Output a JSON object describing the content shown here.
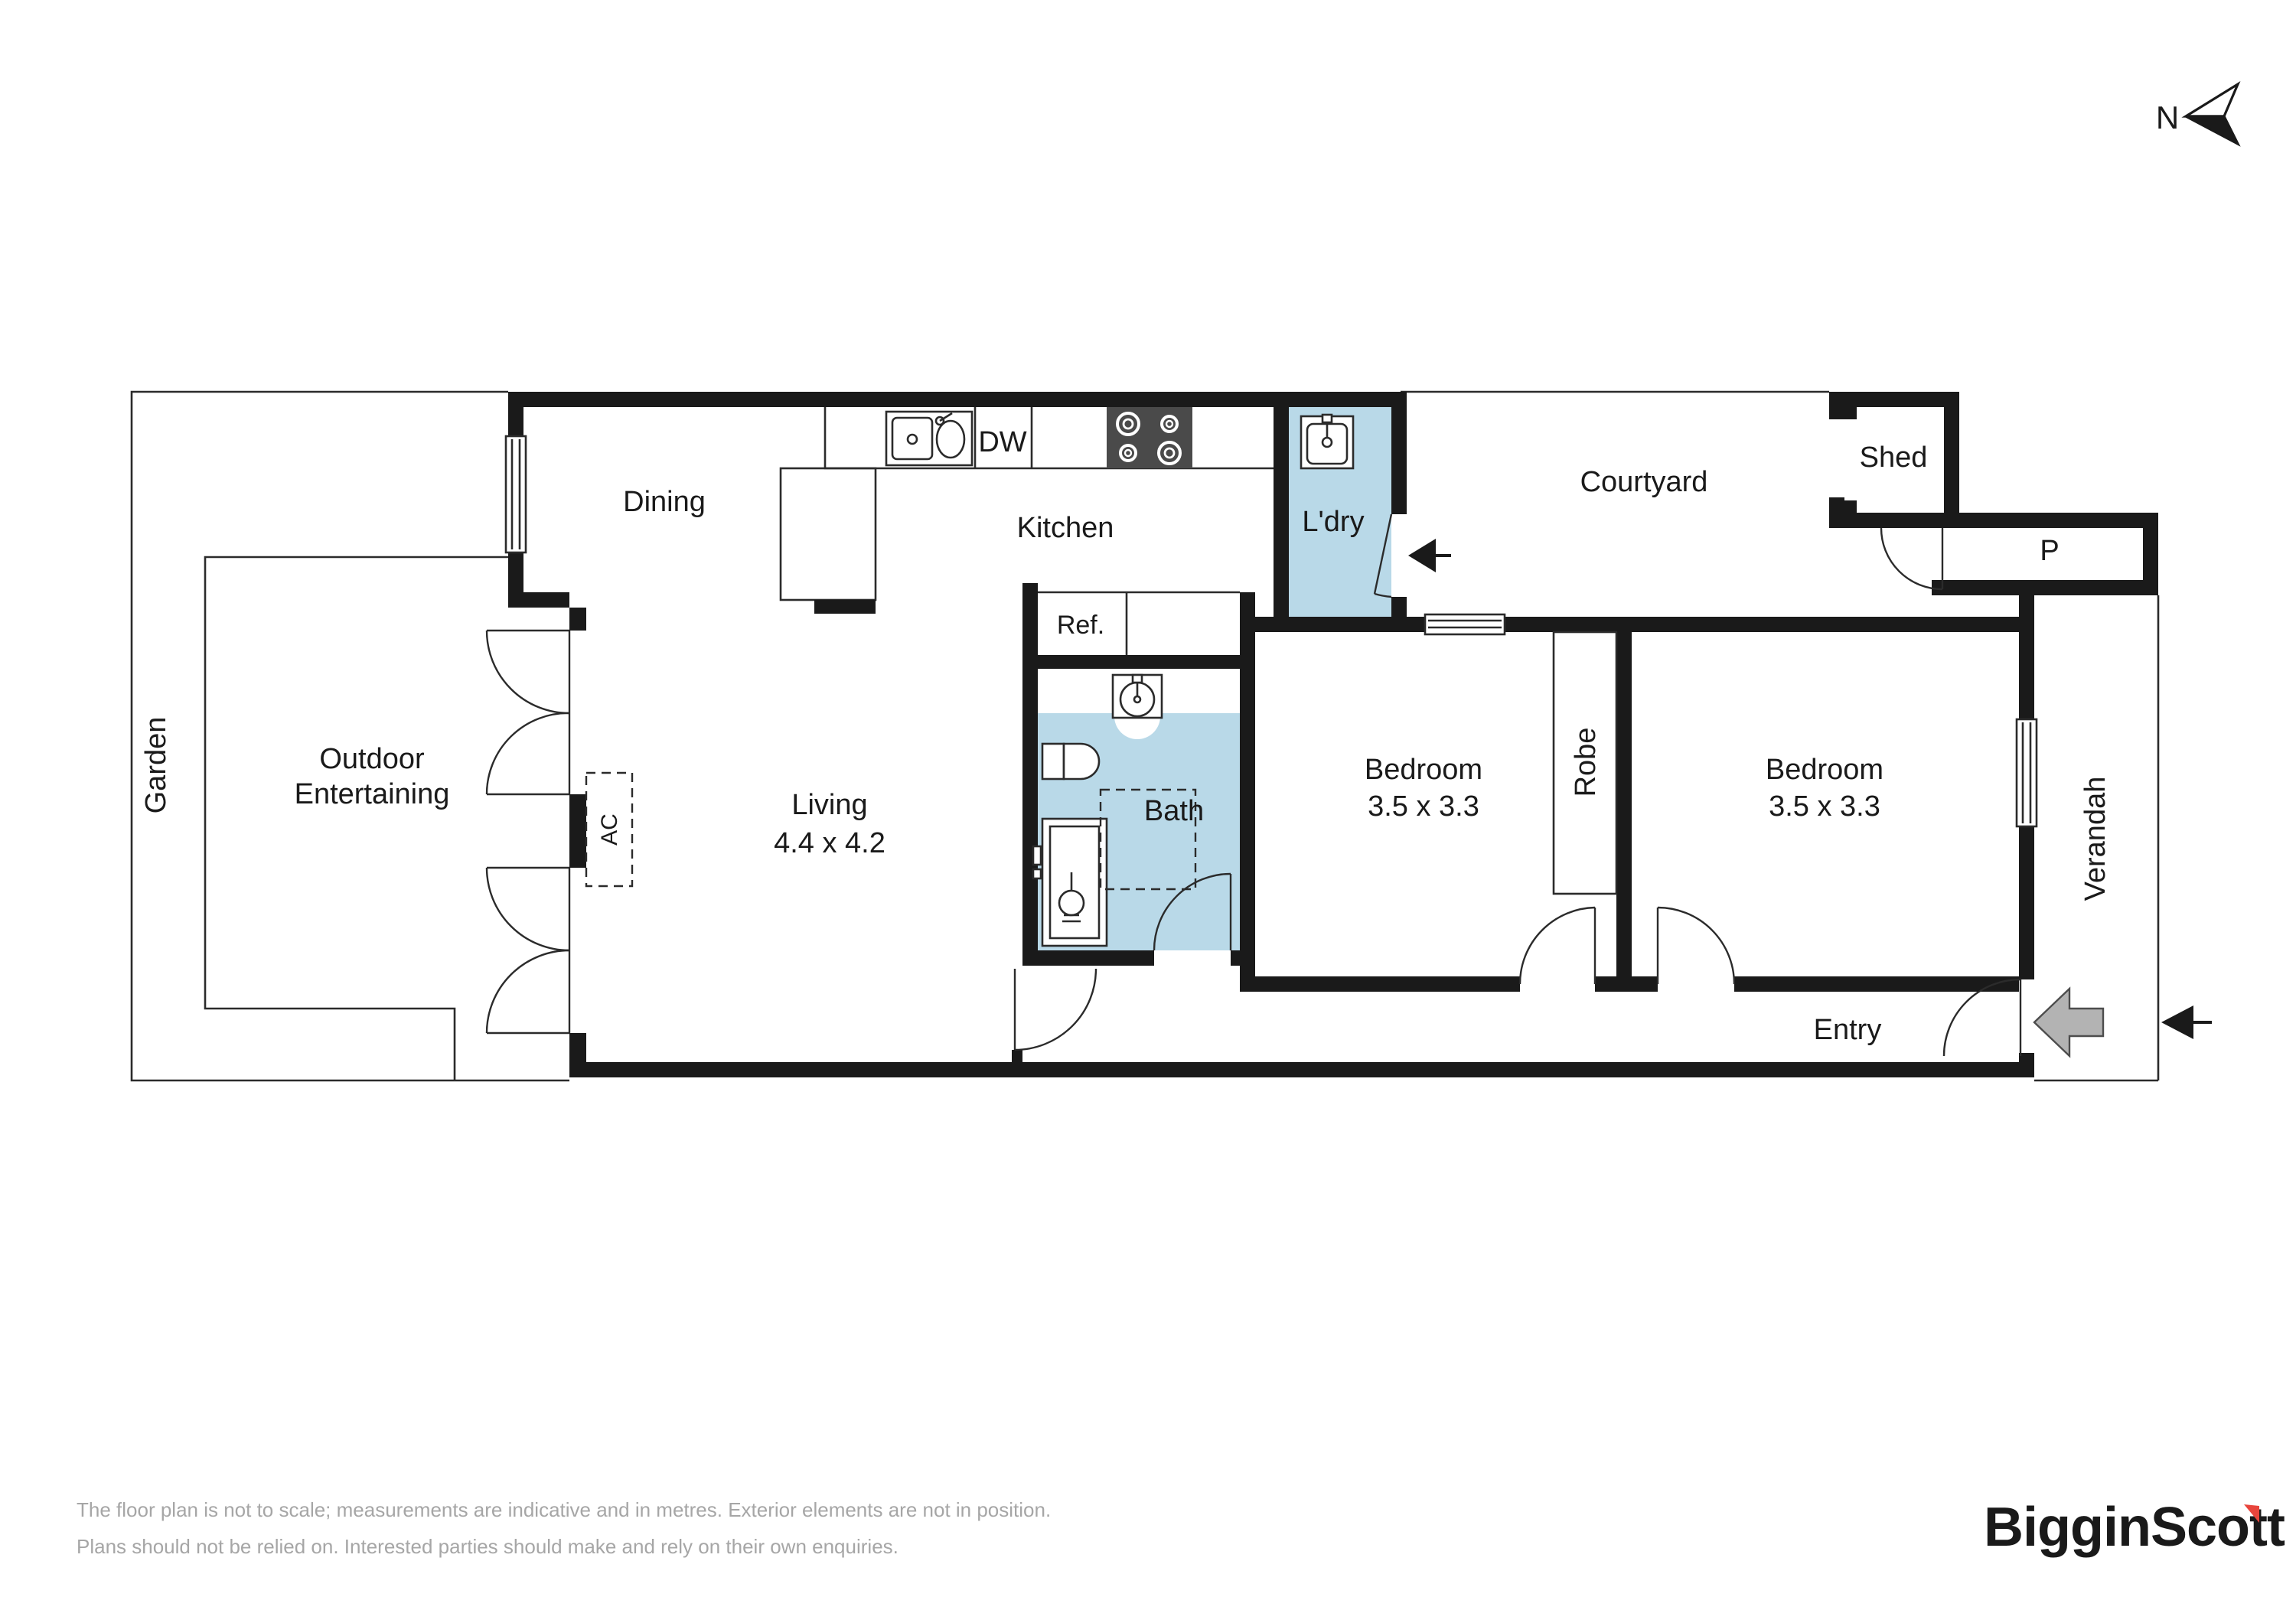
{
  "compass": {
    "label": "N"
  },
  "rooms": {
    "garden": "Garden",
    "outdoor_line1": "Outdoor",
    "outdoor_line2": "Entertaining",
    "dining": "Dining",
    "kitchen": "Kitchen",
    "dw": "DW",
    "ldry": "L'dry",
    "courtyard": "Courtyard",
    "shed": "Shed",
    "p": "P",
    "ref": "Ref.",
    "living": "Living",
    "living_dims": "4.4 x 4.2",
    "bath": "Bath",
    "bedroom1": "Bedroom",
    "bedroom1_dims": "3.5 x 3.3",
    "robe": "Robe",
    "bedroom2": "Bedroom",
    "bedroom2_dims": "3.5 x 3.3",
    "verandah": "Verandah",
    "entry": "Entry",
    "ac": "AC"
  },
  "disclaimer": {
    "line1": "The floor plan is not to scale; measurements are indicative and in metres. Exterior elements are not in position.",
    "line2": "Plans should not be relied on. Interested parties should make and rely on their own enquiries."
  },
  "brand": {
    "name": "BigginScott"
  },
  "colors": {
    "wet_area": "#b9d9e8",
    "wall": "#1a1a1a",
    "brand_navy": "#16243d",
    "brand_red": "#e8453c",
    "entry_arrow_gray": "#b3b3b3",
    "disclaimer_gray": "#a6a6a6"
  }
}
